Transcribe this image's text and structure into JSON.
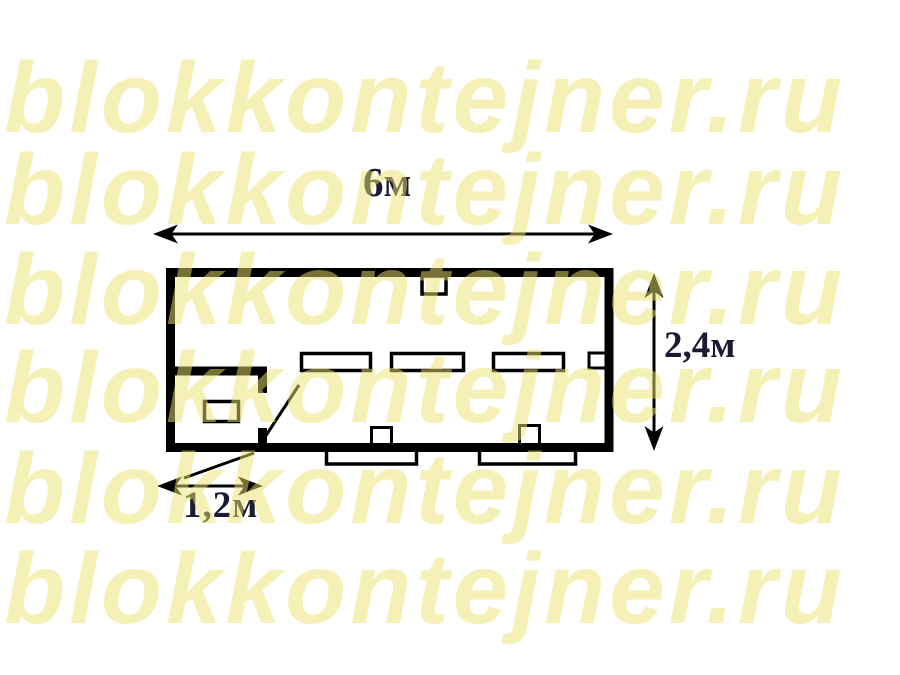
{
  "page": {
    "background_color": "#ffffff"
  },
  "watermark": {
    "text": "blokkontejner.ru",
    "rows": 6,
    "color_hex": "#ece46e",
    "opacity": 0.5
  },
  "floorplan": {
    "line_color": "#000000",
    "label_color": "#1b1b33",
    "labels": {
      "length": "6м",
      "width": "2,4м",
      "entry_width": "1,2м"
    }
  }
}
